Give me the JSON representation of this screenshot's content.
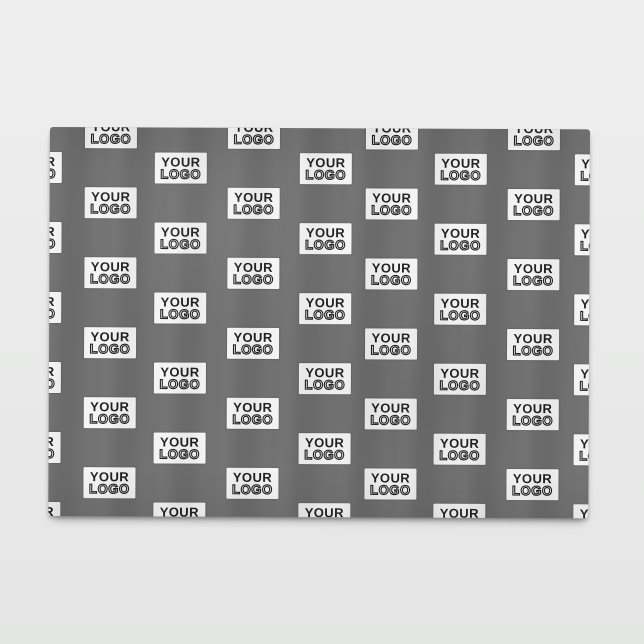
{
  "product_photo": {
    "logo_badge": {
      "line1": "YOUR",
      "line2": "LOGO"
    },
    "colors": {
      "page_background": "#e8e9e8",
      "blanket_fabric": "#6f6f6f",
      "badge_background": "#f4f4f4",
      "badge_text": "#1e1e1e"
    }
  }
}
